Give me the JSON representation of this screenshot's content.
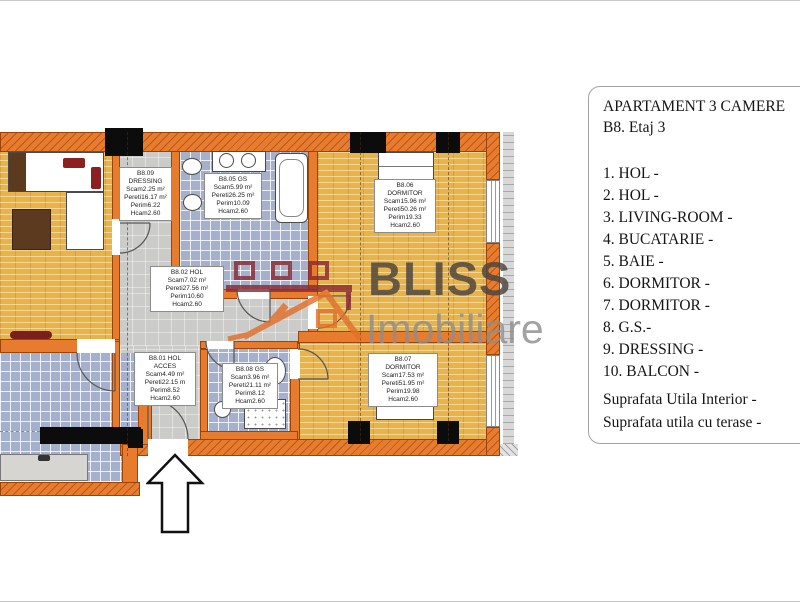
{
  "panel": {
    "title": "APARTAMENT 3 CAMERE",
    "subtitle": "B8. Etaj 3",
    "room_list": [
      "1. HOL -",
      "2. HOL -",
      "3. LIVING-ROOM -",
      "4. BUCATARIE -",
      "5. BAIE -",
      "6. DORMITOR -",
      "7. DORMITOR -",
      "8. G.S.-",
      "9. DRESSING -",
      "10. BALCON -"
    ],
    "summary": [
      "Suprafata Utila Interior -",
      "Suprafata utila cu terase -"
    ]
  },
  "watermark": {
    "brand": "BLISS",
    "brand_sub": "Imobiliare",
    "brand_color": "#4b433e",
    "brand_sub_color": "#8e8e8e",
    "logo_maroon": "#8a2a33",
    "logo_orange": "#e2702b"
  },
  "floorplan": {
    "labels": {
      "dressing": [
        "B8.09",
        "DRESSING",
        "Scam2.25 m²",
        "Pereti16.17 m²",
        "Perim6.22",
        "Hcam2.60"
      ],
      "baie": [
        "B8.05 GS",
        "Scam5.99 m²",
        "Pereti26.25 m²",
        "Perim10.09",
        "Hcam2.60"
      ],
      "dormitor_1": [
        "B8.06",
        "DORMITOR",
        "Scam15.96 m²",
        "Pereti50.26 m²",
        "Perim19.33",
        "Hcam2.60"
      ],
      "hol": [
        "B8.02 HOL",
        "Scam7.02 m²",
        "Pereti27.56 m²",
        "Perim10.60",
        "Hcam2.60"
      ],
      "hol_acces": [
        "B8.01 HOL",
        "ACCES",
        "Scam4.49 m²",
        "Pereti22.15 m",
        "Perim8.52",
        "Hcam2.60"
      ],
      "gs": [
        "B8.08 GS",
        "Scam3.96 m²",
        "Pereti21.11 m²",
        "Perim8.12",
        "Hcam2.60"
      ],
      "dormitor_2": [
        "B8.07",
        "DORMITOR",
        "Scam17.53 m²",
        "Pereti51.95 m²",
        "Perim19.98",
        "Hcam2.60"
      ]
    },
    "colors": {
      "wall": "#e87c2e",
      "wood_floor": "#e7b34a",
      "tile_floor": "#a5b0cd",
      "grey_floor": "#cbcbc9"
    }
  }
}
